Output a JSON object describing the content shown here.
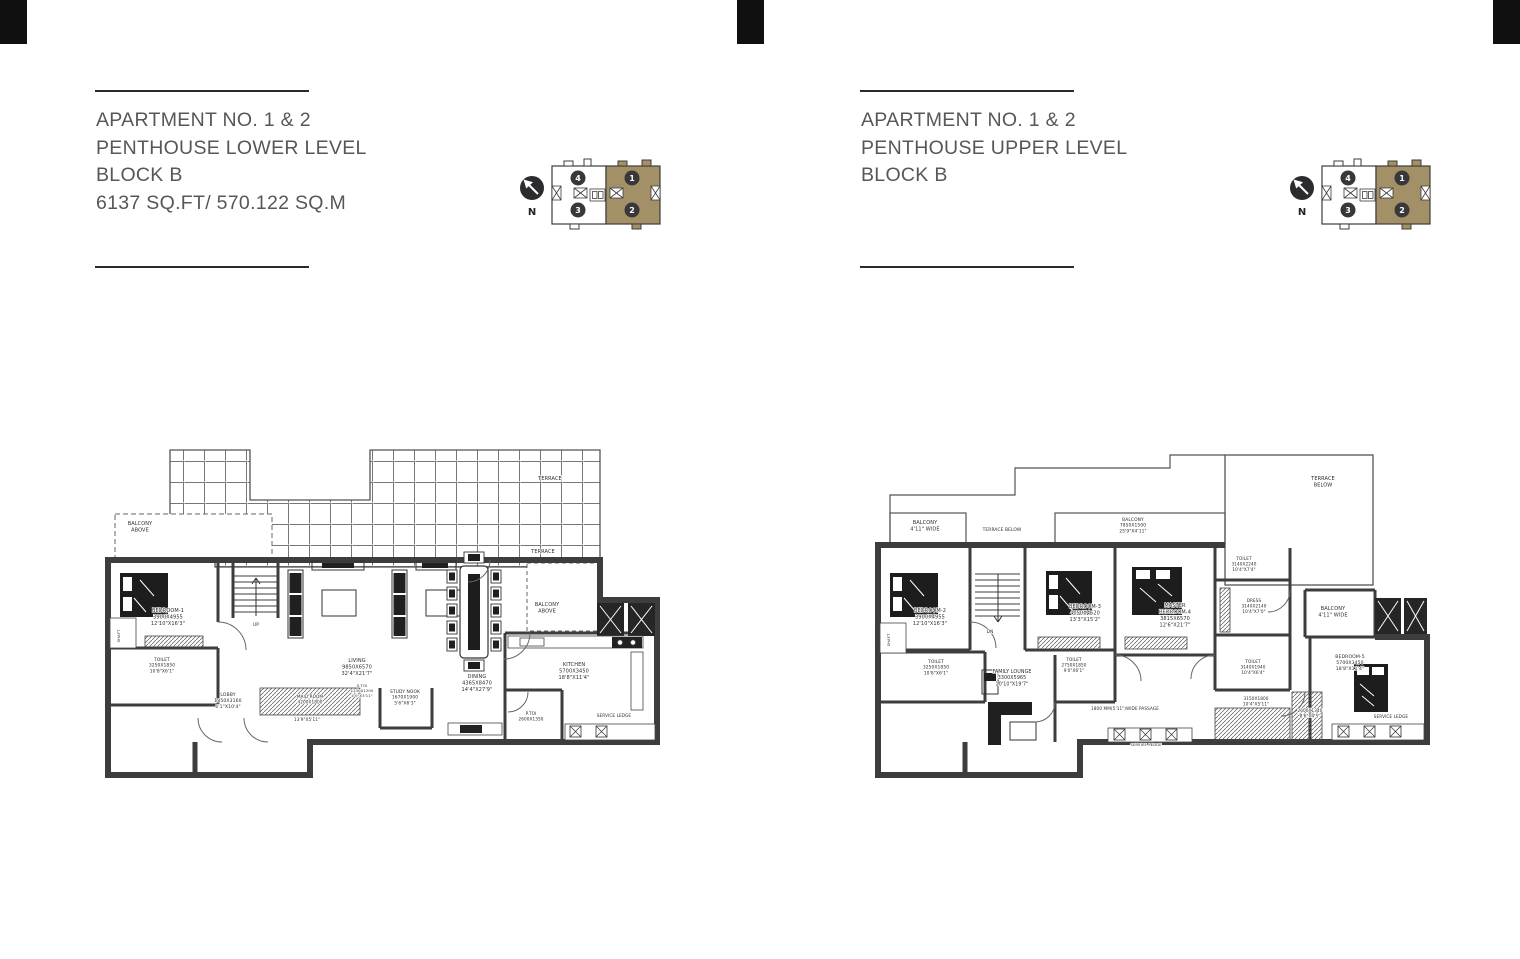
{
  "page": {
    "background": "#ffffff",
    "corner_mark_color": "#101010",
    "wall_color": "#3d3d3d",
    "rule_color": "#2b2b2b",
    "title_color": "#55575a"
  },
  "left_page": {
    "title": {
      "lines": [
        "APARTMENT NO. 1 & 2",
        "PENTHOUSE LOWER LEVEL",
        "BLOCK B",
        "6137 SQ.FT/ 570.122 SQ.M"
      ]
    },
    "keyplan": {
      "north_label": "N",
      "shaded_color": "#a39066",
      "units": [
        {
          "n": "4",
          "x": 60,
          "y": 30
        },
        {
          "n": "3",
          "x": 60,
          "y": 62
        },
        {
          "n": "1",
          "x": 114,
          "y": 30
        },
        {
          "n": "2",
          "x": 114,
          "y": 62
        }
      ]
    },
    "plan": {
      "name": "Penthouse Lower Level floor plan",
      "labels": [
        {
          "x": 450,
          "y": 40,
          "size": 5,
          "lines": [
            "TERRACE"
          ]
        },
        {
          "x": 443,
          "y": 113,
          "size": 5,
          "lines": [
            "TERRACE"
          ]
        },
        {
          "x": 40,
          "y": 85,
          "size": 5,
          "lines": [
            "BALCONY",
            "ABOVE"
          ]
        },
        {
          "x": 68,
          "y": 172,
          "size": 5,
          "lines": [
            "BEDROOM-1",
            "3900X4955",
            "12'10\"X16'3\""
          ]
        },
        {
          "x": 62,
          "y": 221,
          "size": 4.4,
          "lines": [
            "TOILET",
            "3250X1850",
            "10'8\"X6'1\""
          ]
        },
        {
          "x": 20,
          "y": 196,
          "size": 3.8,
          "rot": -90,
          "lines": [
            "SHAFT"
          ]
        },
        {
          "x": 128,
          "y": 256,
          "size": 4.6,
          "lines": [
            "LOBBY",
            "1850X3160",
            "6'1\"X10'4\""
          ]
        },
        {
          "x": 156,
          "y": 186,
          "size": 4.4,
          "lines": [
            "UP"
          ]
        },
        {
          "x": 257,
          "y": 222,
          "size": 5,
          "lines": [
            "LIVING",
            "9850X6570",
            "32'4\"X21'7\""
          ]
        },
        {
          "x": 210,
          "y": 258,
          "size": 4.2,
          "lines": [
            "MAID ROOM",
            "4200X1800"
          ]
        },
        {
          "x": 207,
          "y": 281,
          "size": 4.2,
          "lines": [
            "13'9\"X5'11\""
          ]
        },
        {
          "x": 262,
          "y": 247,
          "size": 3.8,
          "lines": [
            "S.TOI",
            "1230X1200",
            "4'0\"X3'11\""
          ]
        },
        {
          "x": 305,
          "y": 253,
          "size": 4.4,
          "lines": [
            "STUDY NOOK",
            "1670X1900",
            "5'6\"X6'3\""
          ]
        },
        {
          "x": 377,
          "y": 238,
          "size": 5,
          "lines": [
            "DINING",
            "4365X8470",
            "14'4\"X27'9\""
          ]
        },
        {
          "x": 474,
          "y": 226,
          "size": 5,
          "lines": [
            "KITCHEN",
            "5700X3450",
            "18'8\"X11'4\""
          ]
        },
        {
          "x": 447,
          "y": 166,
          "size": 5,
          "lines": [
            "BALCONY",
            "ABOVE"
          ]
        },
        {
          "x": 431,
          "y": 275,
          "size": 4.2,
          "lines": [
            "P.TOI",
            "2600X1350"
          ]
        },
        {
          "x": 514,
          "y": 277,
          "size": 4.2,
          "lines": [
            "SERVICE LEDGE"
          ]
        }
      ]
    }
  },
  "right_page": {
    "title": {
      "lines": [
        "APARTMENT NO. 1 & 2",
        "PENTHOUSE UPPER LEVEL",
        "BLOCK B"
      ]
    },
    "keyplan": {
      "north_label": "N",
      "shaded_color": "#a39066",
      "units": [
        {
          "n": "4",
          "x": 60,
          "y": 30
        },
        {
          "n": "3",
          "x": 60,
          "y": 62
        },
        {
          "n": "1",
          "x": 114,
          "y": 30
        },
        {
          "n": "2",
          "x": 114,
          "y": 62
        }
      ]
    },
    "plan": {
      "name": "Penthouse Upper Level floor plan",
      "labels": [
        {
          "x": 55,
          "y": 84,
          "size": 5,
          "lines": [
            "BALCONY",
            "4'11\" WIDE"
          ]
        },
        {
          "x": 132,
          "y": 91,
          "size": 4.4,
          "lines": [
            "TERRACE BELOW"
          ]
        },
        {
          "x": 263,
          "y": 81,
          "size": 4.4,
          "lines": [
            "BALCONY",
            "7850X1500",
            "25'9\"X4'11\""
          ]
        },
        {
          "x": 453,
          "y": 40,
          "size": 5,
          "lines": [
            "TERRACE",
            "BELOW"
          ]
        },
        {
          "x": 60,
          "y": 172,
          "size": 5,
          "lines": [
            "BEDROOM-2",
            "3900X4955",
            "12'10\"X16'3\""
          ]
        },
        {
          "x": 66,
          "y": 223,
          "size": 4.4,
          "lines": [
            "TOILET",
            "3250X1850",
            "10'8\"X6'1\""
          ]
        },
        {
          "x": 20,
          "y": 200,
          "size": 3.8,
          "rot": -90,
          "lines": [
            "SHAFT"
          ]
        },
        {
          "x": 120,
          "y": 193,
          "size": 4.4,
          "lines": [
            "DN"
          ]
        },
        {
          "x": 215,
          "y": 168,
          "size": 5,
          "lines": [
            "BEDROOM-3",
            "4050X4620",
            "13'3\"X15'2\""
          ]
        },
        {
          "x": 204,
          "y": 221,
          "size": 4.2,
          "lines": [
            "TOILET",
            "2750X1850",
            "9'0\"X6'1\""
          ]
        },
        {
          "x": 305,
          "y": 167,
          "size": 5,
          "lines": [
            "MASTER",
            "BEDROOM-4",
            "3815X6570",
            "12'6\"X21'7\""
          ]
        },
        {
          "x": 374,
          "y": 120,
          "size": 4.2,
          "lines": [
            "TOILET",
            "3140X2240",
            "10'4\"X7'4\""
          ]
        },
        {
          "x": 384,
          "y": 162,
          "size": 4.2,
          "lines": [
            "DRESS",
            "3140X2140",
            "10'4\"X7'0\""
          ]
        },
        {
          "x": 463,
          "y": 170,
          "size": 5,
          "lines": [
            "BALCONY",
            "4'11\" WIDE"
          ]
        },
        {
          "x": 142,
          "y": 233,
          "size": 4.8,
          "lines": [
            "FAMILY LOUNGE",
            "3300X5965",
            "10'10\"X19'7\""
          ]
        },
        {
          "x": 255,
          "y": 270,
          "size": 4.2,
          "lines": [
            "1800 MM(5'11\")WIDE PASSAGE"
          ]
        },
        {
          "x": 383,
          "y": 223,
          "size": 4.2,
          "lines": [
            "TOILET",
            "3140X1940",
            "10'4\"X6'4\""
          ]
        },
        {
          "x": 386,
          "y": 260,
          "size": 4.2,
          "lines": [
            "3150X1800",
            "10'4\"X5'11\""
          ]
        },
        {
          "x": 440,
          "y": 272,
          "size": 4.2,
          "lines": [
            "2600X1340",
            "8'6\"X4'5\""
          ]
        },
        {
          "x": 480,
          "y": 218,
          "size": 4.6,
          "lines": [
            "BEDROOM-5",
            "5700X3450",
            "18'8\"X11'4\""
          ]
        },
        {
          "x": 521,
          "y": 278,
          "size": 4.2,
          "lines": [
            "SERVICE LEDGE"
          ]
        },
        {
          "x": 276,
          "y": 306,
          "size": 3.8,
          "lines": [
            "SERVICE LEDGE"
          ]
        }
      ]
    }
  }
}
